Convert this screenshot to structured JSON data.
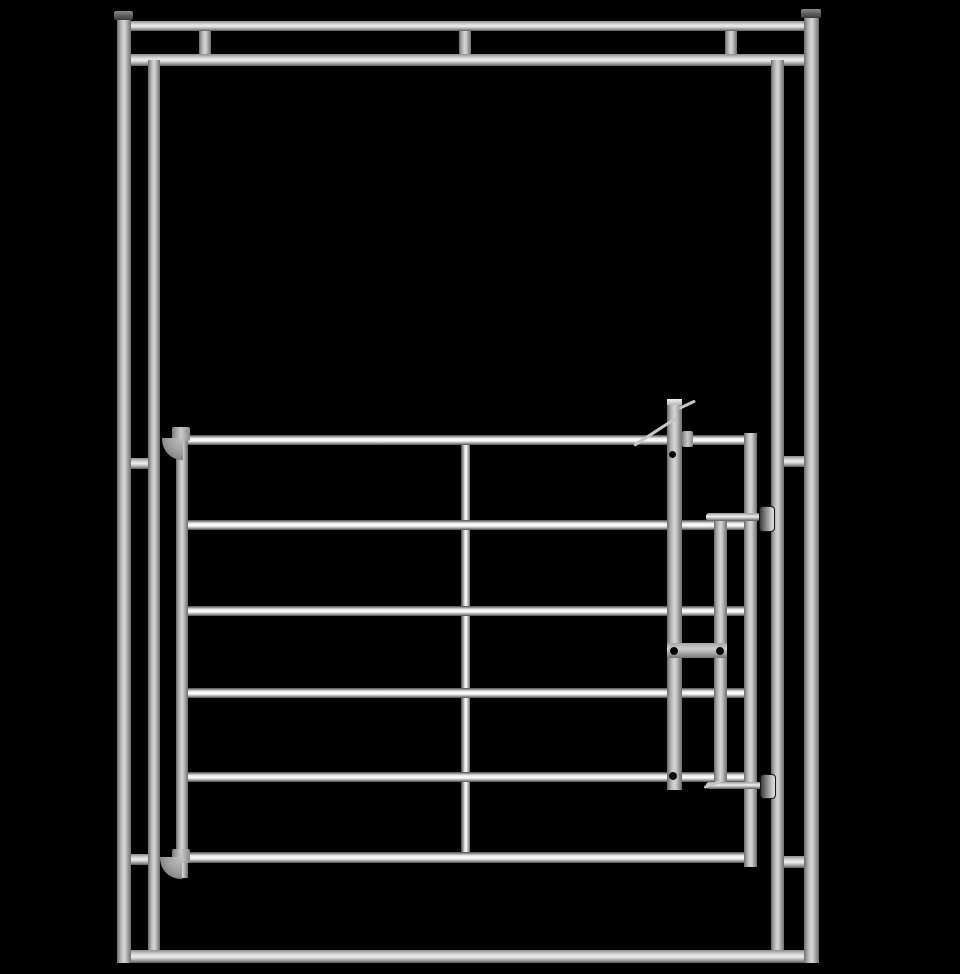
{
  "scene": {
    "title": "galvanized-steel-gate-panel-render",
    "description": "3D product render of a silver galvanized steel livestock gate hung inside a tubular frame, on a black background. No text, buttons or UI controls are visible.",
    "background_color": "#000000",
    "steel_light": "#d6d6d6",
    "steel_mid": "#a9a9a9",
    "steel_dark": "#5e5e5e",
    "highlight": "#ffffff"
  },
  "canvas": {
    "width": 960,
    "height": 974
  },
  "elements": [
    {
      "name": "frame-top-rail",
      "cls": "tube-h",
      "x": 130,
      "y": 21,
      "w": 678,
      "h": 10,
      "z": 3
    },
    {
      "name": "frame-upper-rail",
      "cls": "tube-h",
      "x": 130,
      "y": 54,
      "w": 678,
      "h": 12,
      "z": 3
    },
    {
      "name": "top-connector-left",
      "cls": "tube-v",
      "x": 199,
      "y": 29,
      "w": 12,
      "h": 27,
      "z": 2
    },
    {
      "name": "top-connector-middle",
      "cls": "tube-v",
      "x": 459,
      "y": 29,
      "w": 12,
      "h": 27,
      "z": 2
    },
    {
      "name": "top-connector-right",
      "cls": "tube-v",
      "x": 725,
      "y": 29,
      "w": 12,
      "h": 27,
      "z": 2
    },
    {
      "name": "outer-left-post",
      "cls": "tube-v",
      "x": 117,
      "y": 14,
      "w": 14,
      "h": 949,
      "z": 4
    },
    {
      "name": "outer-left-post-cap",
      "cls": "cap",
      "x": 114,
      "y": 11,
      "w": 19,
      "h": 9,
      "z": 5
    },
    {
      "name": "outer-right-post",
      "cls": "tube-v",
      "x": 804,
      "y": 12,
      "w": 15,
      "h": 951,
      "z": 4
    },
    {
      "name": "outer-right-post-cap",
      "cls": "cap",
      "x": 801,
      "y": 9,
      "w": 20,
      "h": 9,
      "z": 5
    },
    {
      "name": "inner-left-post",
      "cls": "tube-v",
      "x": 148,
      "y": 60,
      "w": 12,
      "h": 890,
      "z": 3
    },
    {
      "name": "inner-right-post",
      "cls": "tube-v",
      "x": 771,
      "y": 60,
      "w": 13,
      "h": 890,
      "z": 3
    },
    {
      "name": "left-mid-connector",
      "cls": "tube-h",
      "x": 130,
      "y": 458,
      "w": 19,
      "h": 11,
      "z": 2
    },
    {
      "name": "right-mid-connector",
      "cls": "tube-h",
      "x": 783,
      "y": 456,
      "w": 22,
      "h": 11,
      "z": 2
    },
    {
      "name": "left-lower-connector",
      "cls": "tube-h",
      "x": 130,
      "y": 854,
      "w": 19,
      "h": 11,
      "z": 2
    },
    {
      "name": "right-lower-connector",
      "cls": "tube-h",
      "x": 783,
      "y": 856,
      "w": 22,
      "h": 12,
      "z": 2
    },
    {
      "name": "frame-bottom-rail",
      "cls": "tube-h",
      "x": 122,
      "y": 950,
      "w": 685,
      "h": 13,
      "z": 3
    },
    {
      "name": "gate-center-brace",
      "cls": "brace",
      "x": 461,
      "y": 440,
      "w": 9,
      "h": 418,
      "z": 2
    },
    {
      "name": "gate-rail-1",
      "cls": "rail",
      "x": 184,
      "y": 435,
      "w": 566,
      "h": 10,
      "z": 3
    },
    {
      "name": "gate-rail-2",
      "cls": "rail",
      "x": 184,
      "y": 520,
      "w": 566,
      "h": 10,
      "z": 3
    },
    {
      "name": "gate-rail-3",
      "cls": "rail",
      "x": 184,
      "y": 606,
      "w": 566,
      "h": 10,
      "z": 3
    },
    {
      "name": "gate-rail-4",
      "cls": "rail",
      "x": 184,
      "y": 688,
      "w": 566,
      "h": 10,
      "z": 3
    },
    {
      "name": "gate-rail-5",
      "cls": "rail",
      "x": 184,
      "y": 772,
      "w": 566,
      "h": 10,
      "z": 3
    },
    {
      "name": "gate-rail-6",
      "cls": "rail",
      "x": 184,
      "y": 852,
      "w": 570,
      "h": 11,
      "z": 3
    },
    {
      "name": "gate-left-stile",
      "cls": "tube-v",
      "x": 176,
      "y": 429,
      "w": 12,
      "h": 449,
      "z": 5
    },
    {
      "name": "gate-right-stile",
      "cls": "tube-v",
      "x": 744,
      "y": 433,
      "w": 13,
      "h": 434,
      "z": 5
    },
    {
      "name": "latch-post",
      "cls": "tube-v",
      "x": 667,
      "y": 399,
      "w": 15,
      "h": 391,
      "z": 6
    },
    {
      "name": "latch-post-top-face",
      "cls": "cap-light",
      "x": 667,
      "y": 399,
      "w": 15,
      "h": 6,
      "z": 7
    },
    {
      "name": "latch-guide-bar",
      "cls": "tube-v",
      "x": 714,
      "y": 514,
      "w": 13,
      "h": 272,
      "z": 6
    },
    {
      "name": "latch-connector-plate",
      "cls": "plate",
      "x": 667,
      "y": 643,
      "w": 60,
      "h": 15,
      "z": 6
    },
    {
      "name": "top-latch-pin",
      "cls": "pin",
      "x": 706,
      "y": 513,
      "w": 54,
      "h": 8,
      "z": 7
    },
    {
      "name": "top-latch-knob",
      "cls": "knob",
      "x": 759,
      "y": 506,
      "w": 16,
      "h": 26,
      "z": 8
    },
    {
      "name": "bottom-latch-pin",
      "cls": "pin",
      "x": 706,
      "y": 782,
      "w": 56,
      "h": 7,
      "z": 7
    },
    {
      "name": "bottom-latch-knob",
      "cls": "knob",
      "x": 760,
      "y": 774,
      "w": 16,
      "h": 25,
      "z": 8
    },
    {
      "name": "latch-handle-pin",
      "cls": "rod",
      "x": 679,
      "y": 407,
      "w": 18,
      "h": 3,
      "z": 7,
      "rot": -25
    },
    {
      "name": "latch-diagonal-rod",
      "cls": "rod",
      "x": 634,
      "y": 444,
      "w": 51,
      "h": 3,
      "z": 7,
      "rot": -33
    },
    {
      "name": "latch-catch-bracket",
      "cls": "bracket",
      "x": 682,
      "y": 431,
      "w": 11,
      "h": 16,
      "z": 5
    },
    {
      "name": "bottom-pin-lever",
      "cls": "rod",
      "x": 704,
      "y": 786,
      "w": 17,
      "h": 3,
      "z": 8,
      "rot": -20
    },
    {
      "name": "top-hinge-clamp",
      "cls": "bracket",
      "x": 172,
      "y": 427,
      "w": 18,
      "h": 14,
      "z": 6
    },
    {
      "name": "top-hinge-curve",
      "cls": "hinge-curve",
      "x": 162,
      "y": 438,
      "w": 21,
      "h": 22,
      "z": 6
    },
    {
      "name": "bottom-hinge-clamp",
      "cls": "bracket",
      "x": 172,
      "y": 849,
      "w": 18,
      "h": 14,
      "z": 6
    },
    {
      "name": "bottom-hinge-curve",
      "cls": "hinge-curve",
      "x": 160,
      "y": 857,
      "w": 22,
      "h": 22,
      "z": 6
    },
    {
      "name": "latch-post-bolt-hole",
      "cls": "hole",
      "x": 669,
      "y": 451,
      "w": 7,
      "h": 7,
      "z": 9
    },
    {
      "name": "plate-bolt-hole-left",
      "cls": "hole",
      "x": 670,
      "y": 647,
      "w": 8,
      "h": 8,
      "z": 9
    },
    {
      "name": "plate-bolt-hole-right",
      "cls": "hole",
      "x": 716,
      "y": 647,
      "w": 8,
      "h": 8,
      "z": 9
    },
    {
      "name": "rail5-bolt-hole",
      "cls": "hole",
      "x": 669,
      "y": 772,
      "w": 8,
      "h": 8,
      "z": 9
    }
  ]
}
